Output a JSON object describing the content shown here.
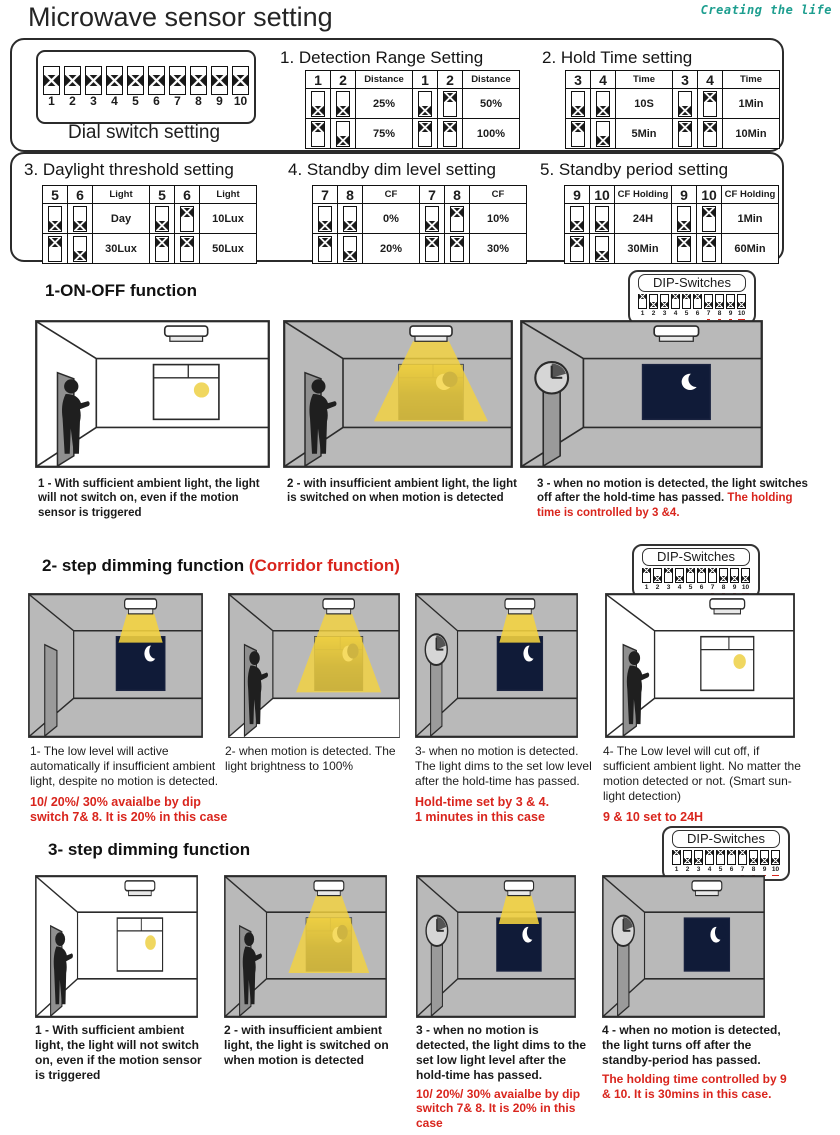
{
  "brand": "Creating the life",
  "title": "Microwave sensor setting",
  "colors": {
    "accent_red": "#d9251d",
    "brand_teal": "#1d9e8f",
    "room_gray": "#b9b9b9",
    "night_window": "#101b38",
    "beam_yellow": "#f4d33f"
  },
  "dial_box": {
    "label": "Dial switch setting",
    "switch_numbers": [
      "1",
      "2",
      "3",
      "4",
      "5",
      "6",
      "7",
      "8",
      "9",
      "10"
    ]
  },
  "settings": [
    {
      "title": "1. Detection Range Setting",
      "col_a": "1",
      "col_b": "2",
      "value_header": "Distance",
      "combos": [
        {
          "a": "down",
          "b": "down",
          "value": "25%"
        },
        {
          "a": "down",
          "b": "up",
          "value": "50%"
        },
        {
          "a": "up",
          "b": "down",
          "value": "75%"
        },
        {
          "a": "up",
          "b": "up",
          "value": "100%"
        }
      ]
    },
    {
      "title": "2. Hold Time setting",
      "col_a": "3",
      "col_b": "4",
      "value_header": "Time",
      "combos": [
        {
          "a": "down",
          "b": "down",
          "value": "10S"
        },
        {
          "a": "down",
          "b": "up",
          "value": "1Min"
        },
        {
          "a": "up",
          "b": "down",
          "value": "5Min"
        },
        {
          "a": "up",
          "b": "up",
          "value": "10Min"
        }
      ]
    },
    {
      "title": "3. Daylight threshold setting",
      "col_a": "5",
      "col_b": "6",
      "value_header": "Light",
      "combos": [
        {
          "a": "down",
          "b": "down",
          "value": "Day"
        },
        {
          "a": "down",
          "b": "up",
          "value": "10Lux"
        },
        {
          "a": "up",
          "b": "down",
          "value": "30Lux"
        },
        {
          "a": "up",
          "b": "up",
          "value": "50Lux"
        }
      ]
    },
    {
      "title": "4. Standby dim level setting",
      "col_a": "7",
      "col_b": "8",
      "value_header": "CF",
      "combos": [
        {
          "a": "down",
          "b": "down",
          "value": "0%"
        },
        {
          "a": "down",
          "b": "up",
          "value": "10%"
        },
        {
          "a": "up",
          "b": "down",
          "value": "20%"
        },
        {
          "a": "up",
          "b": "up",
          "value": "30%"
        }
      ]
    },
    {
      "title": "5. Standby period setting",
      "col_a": "9",
      "col_b": "10",
      "value_header": "CF Holding",
      "combos": [
        {
          "a": "down",
          "b": "down",
          "value": "24H"
        },
        {
          "a": "down",
          "b": "up",
          "value": "1Min"
        },
        {
          "a": "up",
          "b": "down",
          "value": "30Min"
        },
        {
          "a": "up",
          "b": "up",
          "value": "60Min"
        }
      ]
    }
  ],
  "dip_badge": {
    "label": "DIP-Switches",
    "numbers": [
      "1",
      "2",
      "3",
      "4",
      "5",
      "6",
      "7",
      "8",
      "9",
      "10"
    ],
    "red_underlined_numbers": [
      "7",
      "8",
      "9",
      "10"
    ]
  },
  "sections": [
    {
      "heading": "1-ON-OFF function",
      "subheading": "",
      "badge_states": [
        "up",
        "down",
        "down",
        "up",
        "up",
        "up",
        "down",
        "down",
        "down",
        "down"
      ],
      "panels": [
        {
          "bg": "white",
          "person": true,
          "lamp": "off",
          "window": "day",
          "clock": false,
          "floor_lit": false
        },
        {
          "bg": "gray",
          "person": true,
          "lamp": "big",
          "window": "night",
          "clock": false,
          "floor_lit": false
        },
        {
          "bg": "gray",
          "person": false,
          "lamp": "off",
          "window": "night",
          "clock": true,
          "floor_lit": false
        }
      ],
      "captions": [
        {
          "text": "1 - With sufficient ambient light, the light will not switch on, even if the motion sensor is triggered",
          "red": ""
        },
        {
          "text": "2 - with insufficient ambient light, the light is switched on when motion is detected",
          "red": ""
        },
        {
          "text": "3 - when no motion is detected, the light switches off after the hold-time has passed.",
          "red": " The holding time is controlled by 3 &4."
        }
      ]
    },
    {
      "heading": "2- step dimming function",
      "subheading": "(Corridor function)",
      "badge_states": [
        "up",
        "down",
        "up",
        "down",
        "up",
        "up",
        "up",
        "down",
        "down",
        "down"
      ],
      "panels": [
        {
          "bg": "gray",
          "person": false,
          "lamp": "small",
          "window": "night",
          "clock": false,
          "floor_lit": false
        },
        {
          "bg": "gray",
          "person": true,
          "lamp": "big",
          "window": "night",
          "clock": false,
          "floor_lit": true
        },
        {
          "bg": "gray",
          "person": false,
          "lamp": "small",
          "window": "night",
          "clock": true,
          "floor_lit": false
        },
        {
          "bg": "white",
          "person": true,
          "lamp": "off",
          "window": "day",
          "clock": false,
          "floor_lit": false
        }
      ],
      "captions": [
        {
          "text": "1-  The low level will active automatically if  insufficient ambient light,  despite no motion is detected.",
          "red": "10/ 20%/ 30% avaialbe by dip switch 7& 8.  It is 20% in this case"
        },
        {
          "text": "2-  when motion is detected. The light brightness to 100%",
          "red": ""
        },
        {
          "text": "3-  when no motion is detected. The light dims to the set low level after the hold-time has passed.",
          "red": "Hold-time set by 3 & 4.\n1 minutes in this case"
        },
        {
          "text": "4-  The Low level will cut off, if sufficient ambient light.  No matter the motion detected or not. (Smart sun-light detection)",
          "red": "9 & 10 set to 24H"
        }
      ]
    },
    {
      "heading": "3- step dimming function",
      "subheading": "",
      "badge_states": [
        "up",
        "down",
        "down",
        "up",
        "up",
        "up",
        "up",
        "down",
        "down",
        "down"
      ],
      "panels": [
        {
          "bg": "white",
          "person": true,
          "lamp": "off",
          "window": "day",
          "clock": false,
          "floor_lit": false
        },
        {
          "bg": "gray",
          "person": true,
          "lamp": "big",
          "window": "night",
          "clock": false,
          "floor_lit": false
        },
        {
          "bg": "gray",
          "person": false,
          "lamp": "small",
          "window": "night",
          "clock": true,
          "floor_lit": false
        },
        {
          "bg": "gray",
          "person": false,
          "lamp": "off",
          "window": "night",
          "clock": true,
          "floor_lit": false
        }
      ],
      "captions": [
        {
          "text": "1 - With sufficient ambient light, the light will not switch on, even if the motion sensor is triggered",
          "red": ""
        },
        {
          "text": "2 - with insufficient ambient light, the light is switched on when motion is detected",
          "red": ""
        },
        {
          "text": "3 - when no motion is detected, the light dims to the set low light level after the hold-time has passed.",
          "red": "10/ 20%/ 30% avaialbe by dip switch 7& 8. It is 20% in this case"
        },
        {
          "text": "4 - when no motion is detected, the light turns off after the standby-period has passed.",
          "red": "The  holding time controlled by 9 & 10. It is 30mins in this case."
        }
      ]
    }
  ]
}
